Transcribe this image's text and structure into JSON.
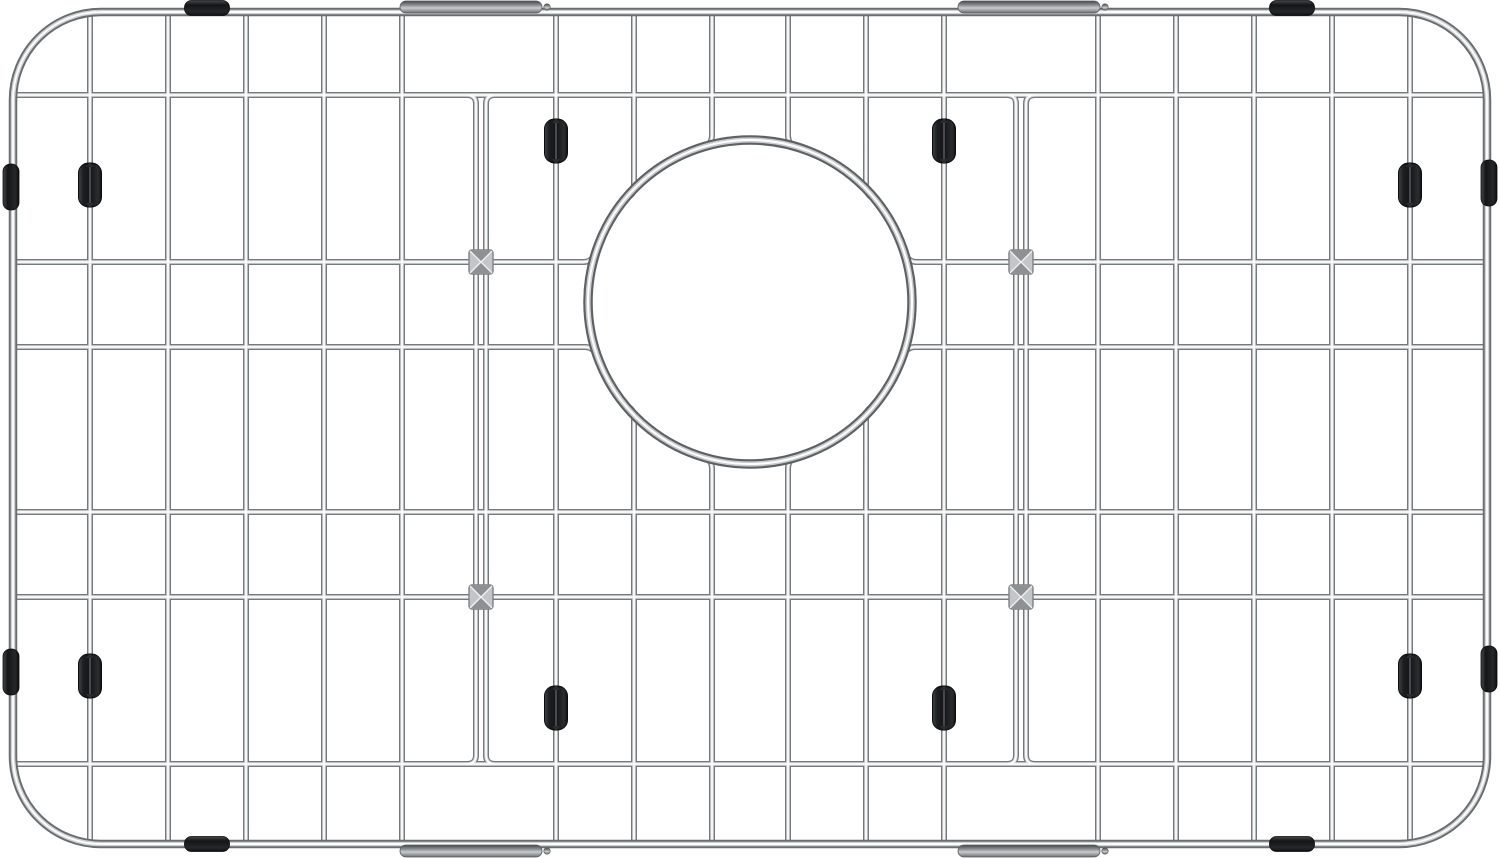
{
  "meta": {
    "subject": "Stainless steel kitchen sink bottom grid protector with round rear drain opening, black rubber feet and bumpers, top-down product photo on white background",
    "canvas": {
      "width": 1500,
      "height": 858,
      "background": "#ffffff"
    }
  },
  "palette": {
    "background": "#ffffff",
    "wire_edge": "#75797c",
    "wire_mid": "#d7d9da",
    "wire_core": "#ffffff",
    "ring_edge": "#5c6164",
    "ring_mid": "#c9cccd",
    "frame_edge": "#686d70",
    "frame_mid": "#cfd2d3",
    "rubber_dark": "#131517",
    "rubber_mid": "#25282a",
    "rubber_light": "#46494c",
    "sleeve_dark": "#44484a",
    "sleeve_mid": "#8c9093",
    "sleeve_light": "#c9cbcc",
    "sleeve_end": "#6b6f72",
    "clip_face": "#c3c6c8",
    "clip_shade": "#8d9194",
    "clip_edge": "#7e8285",
    "clip_glint": "#f2f3f4"
  },
  "frame": {
    "x": 13,
    "y": 12,
    "width": 1474,
    "height": 832,
    "corner_radius": 88,
    "tube": [
      [
        "#686d70",
        8.5
      ],
      [
        "#cfd2d3",
        4.6
      ],
      [
        "#ffffff",
        1.8
      ]
    ]
  },
  "grid": {
    "inner_left": 15,
    "inner_right": 1485,
    "inner_top": 15,
    "inner_bottom": 843,
    "vertical_wires_full": [
      90,
      168,
      246,
      324,
      402,
      556,
      944,
      1098,
      1176,
      1254,
      1332,
      1410
    ],
    "vertical_wires_to_ring": [
      634,
      712,
      788,
      866
    ],
    "horizontal_wires_full": [
      95,
      512,
      597,
      764
    ],
    "horizontal_wires_to_ring": [
      262,
      347
    ],
    "double_wire_centers": [
      481,
      1021
    ],
    "double_wire_gap": 10,
    "double_wire_top": 95,
    "double_wire_bottom": 764,
    "curl_radius": 9,
    "ring_splay": 8,
    "tube": [
      [
        "#75797c",
        6
      ],
      [
        "#d7d9da",
        3.4
      ],
      [
        "#ffffff",
        1.5
      ]
    ]
  },
  "drain_ring": {
    "cx": 750,
    "cy": 302,
    "radius": 162,
    "tube": [
      [
        "#5c6164",
        9.5
      ],
      [
        "#c9cccd",
        5.2
      ],
      [
        "#ffffff",
        2
      ]
    ]
  },
  "cross_clips": {
    "size": 24,
    "positions": [
      [
        481,
        262
      ],
      [
        481,
        597
      ],
      [
        1021,
        262
      ],
      [
        1021,
        597
      ]
    ]
  },
  "wire_feet": {
    "width": 23,
    "height": 44,
    "corner": 10,
    "positions": [
      [
        90,
        185
      ],
      [
        1410,
        185
      ],
      [
        90,
        676
      ],
      [
        1410,
        676
      ],
      [
        556,
        141
      ],
      [
        944,
        141
      ],
      [
        556,
        708
      ],
      [
        944,
        708
      ]
    ]
  },
  "edge_bumpers": {
    "horizontal_size": {
      "width": 45,
      "height": 15
    },
    "vertical_size": {
      "width": 16,
      "height": 46
    },
    "top": [
      [
        207,
        8
      ],
      [
        1292,
        8
      ]
    ],
    "bottom": [
      [
        207,
        844
      ],
      [
        1292,
        844
      ]
    ],
    "left": [
      [
        11,
        187
      ],
      [
        11,
        672
      ]
    ],
    "right": [
      [
        1489,
        183
      ],
      [
        1489,
        669
      ]
    ]
  },
  "sleeves": {
    "length": 142,
    "thickness": 12,
    "corner": 6,
    "positions": [
      [
        471,
        7
      ],
      [
        1029,
        7
      ],
      [
        471,
        851
      ],
      [
        1029,
        851
      ]
    ]
  }
}
